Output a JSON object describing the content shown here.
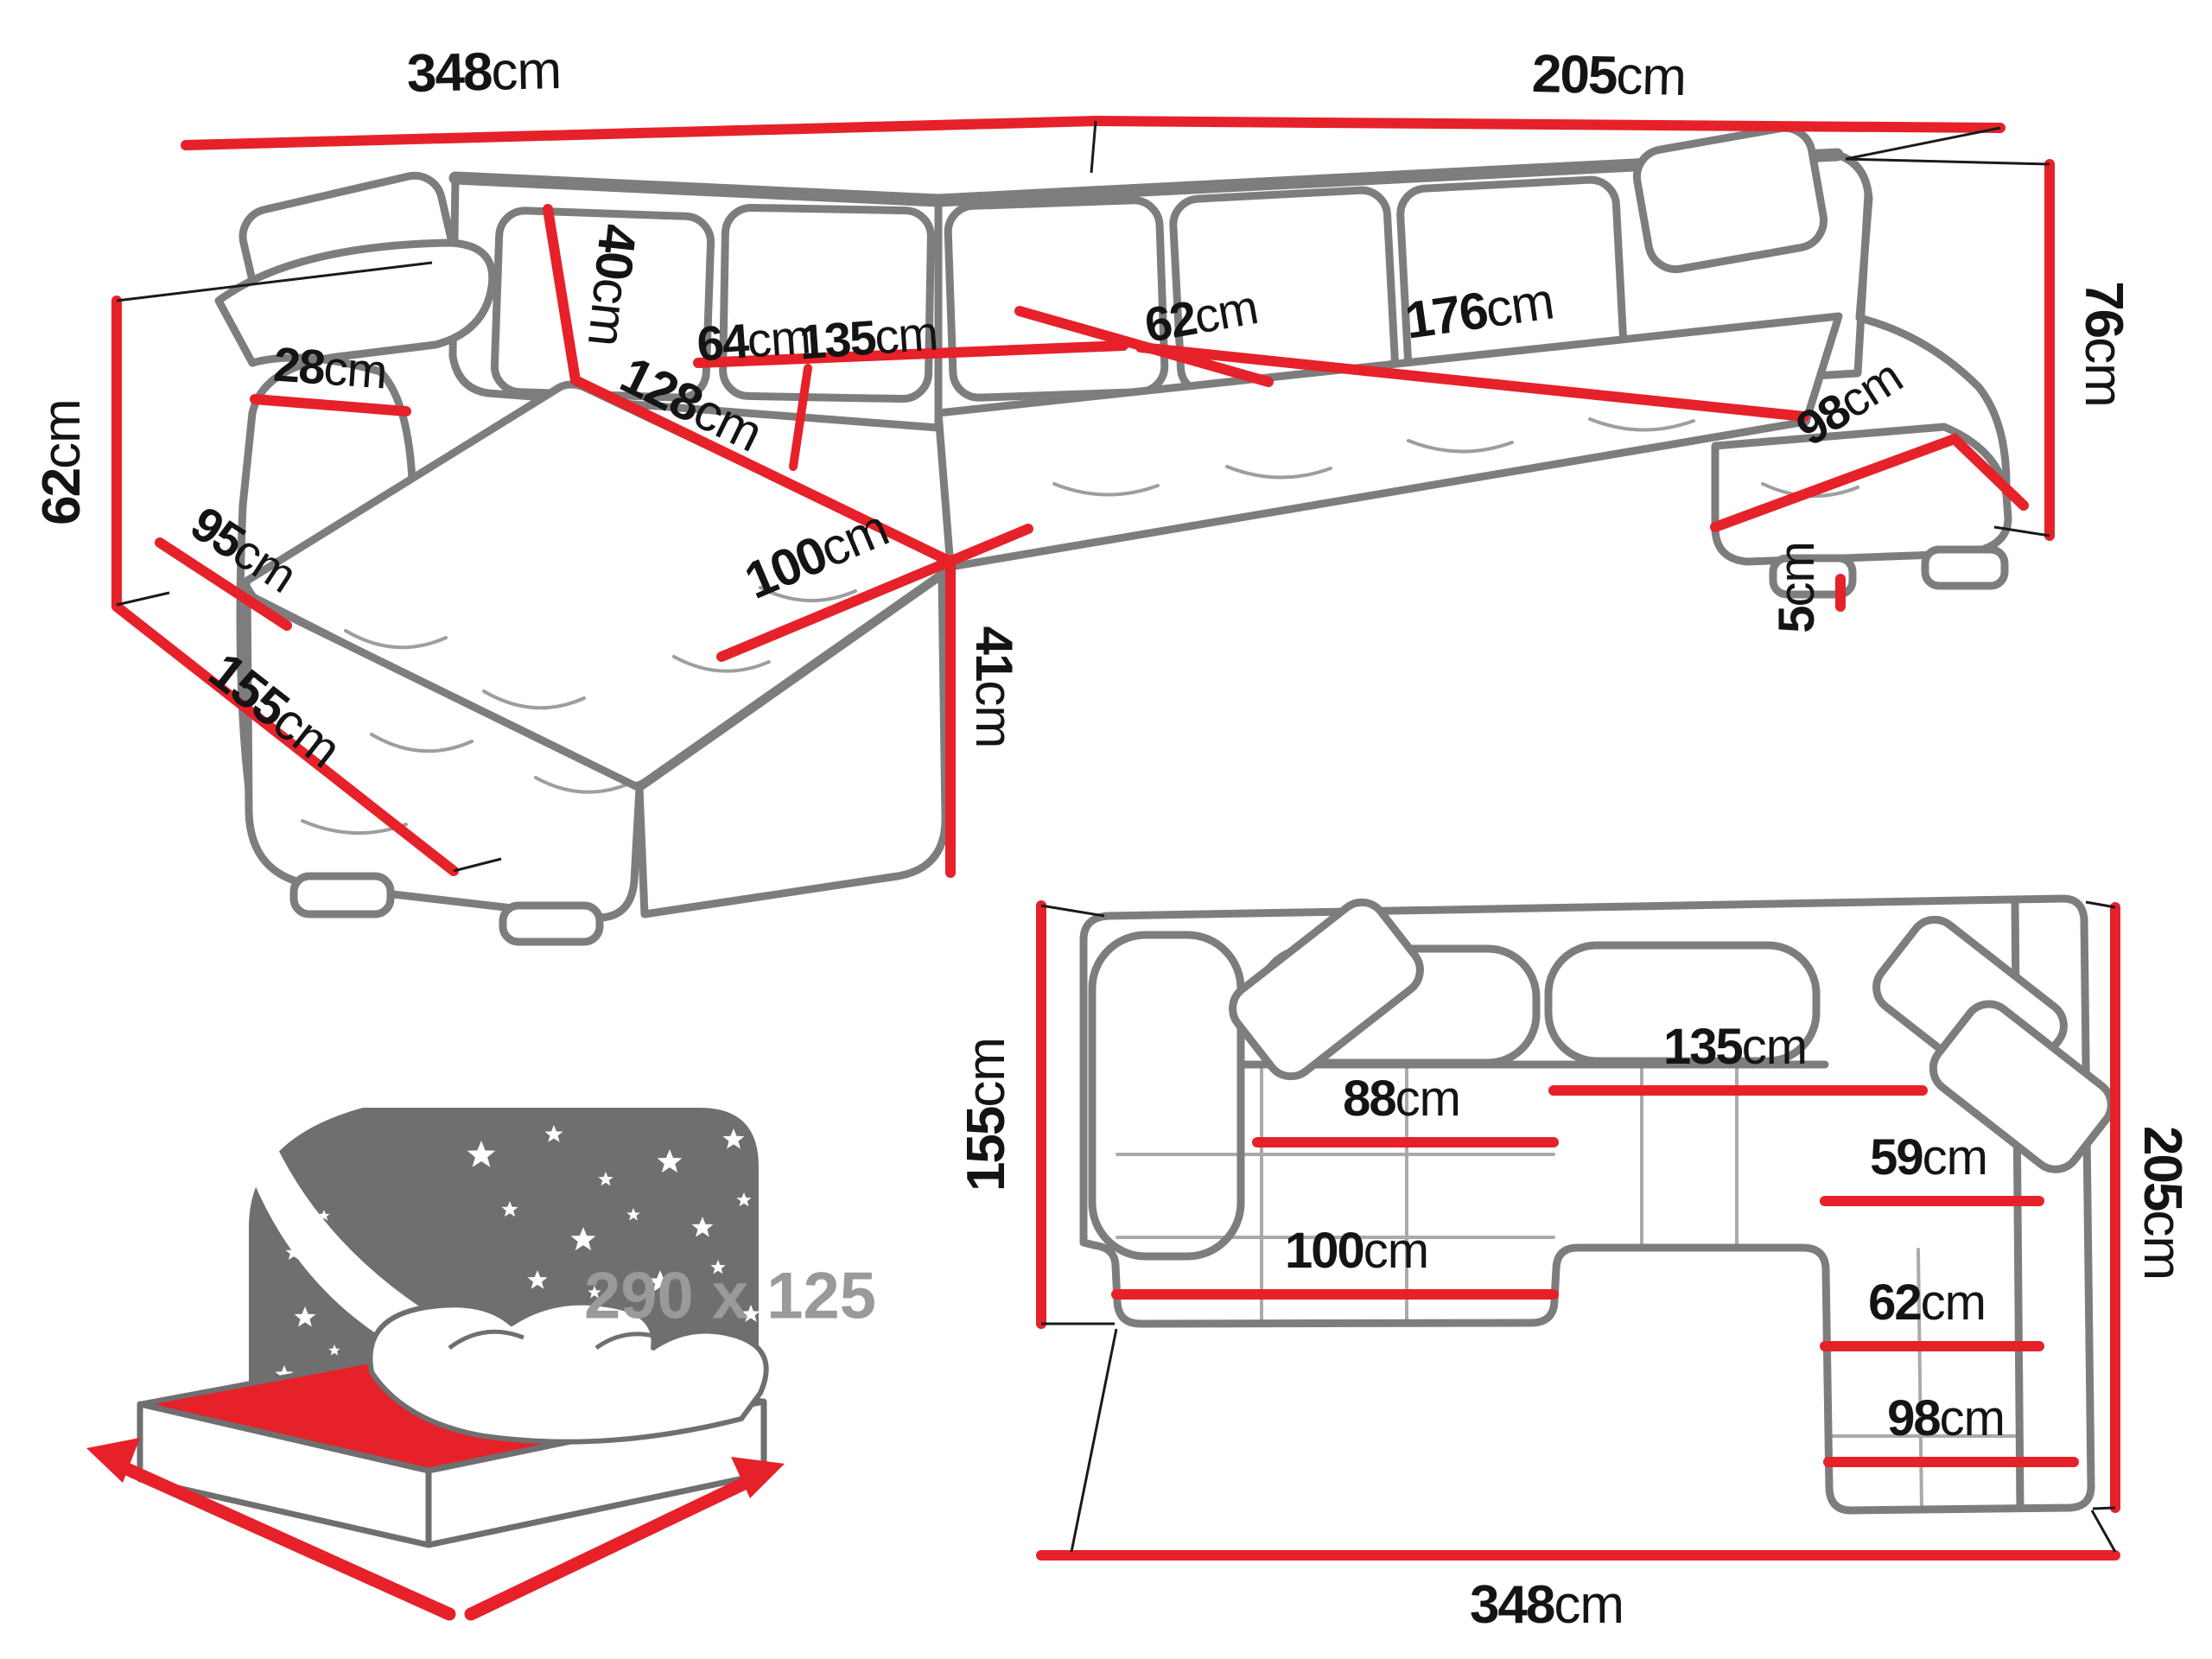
{
  "colors": {
    "accent_red": "#e62129",
    "outline_gray": "#7d7d7d",
    "icon_gray": "#6f6f70",
    "label_black": "#141414",
    "size_text_gray": "#9a9a9b"
  },
  "icons": {
    "sleep_function": "sleeping-bed-with-stars-icon",
    "star": "star-icon",
    "dimension_arrow": "red-measure-arrow"
  },
  "perspective_view": {
    "dims": {
      "back_width": {
        "value": "348",
        "unit": "cm"
      },
      "right_length": {
        "value": "205",
        "unit": "cm"
      },
      "back_height": {
        "value": "76",
        "unit": "cm"
      },
      "leg_height": {
        "value": "5",
        "unit": "cm"
      },
      "arm_height": {
        "value": "62",
        "unit": "cm"
      },
      "floor_depth": {
        "value": "155",
        "unit": "cm"
      },
      "arm_side_length": {
        "value": "95",
        "unit": "cm"
      },
      "arm_top_width": {
        "value": "28",
        "unit": "cm"
      },
      "cushion_height": {
        "value": "40",
        "unit": "cm"
      },
      "chaise_length": {
        "value": "128",
        "unit": "cm"
      },
      "chaise_width": {
        "value": "100",
        "unit": "cm"
      },
      "seat_height": {
        "value": "41",
        "unit": "cm"
      },
      "seat_left_width": {
        "value": "64",
        "unit": "cm"
      },
      "seat_center_width": {
        "value": "135",
        "unit": "cm"
      },
      "corner_seat_depth": {
        "value": "62",
        "unit": "cm"
      },
      "right_seat_length": {
        "value": "176",
        "unit": "cm"
      },
      "right_chaise_width": {
        "value": "98",
        "unit": "cm"
      }
    }
  },
  "plan_view": {
    "dims": {
      "left_depth": {
        "value": "155",
        "unit": "cm"
      },
      "chaise_width": {
        "value": "88",
        "unit": "cm"
      },
      "center_seat_width": {
        "value": "135",
        "unit": "cm"
      },
      "corner_width": {
        "value": "59",
        "unit": "cm"
      },
      "right_seat_width": {
        "value": "62",
        "unit": "cm"
      },
      "chaise_front_width": {
        "value": "100",
        "unit": "cm"
      },
      "right_chaise_width": {
        "value": "98",
        "unit": "cm"
      },
      "right_depth": {
        "value": "205",
        "unit": "cm"
      },
      "total_width": {
        "value": "348",
        "unit": "cm"
      }
    }
  },
  "sleeper": {
    "size": "290 x 125"
  }
}
